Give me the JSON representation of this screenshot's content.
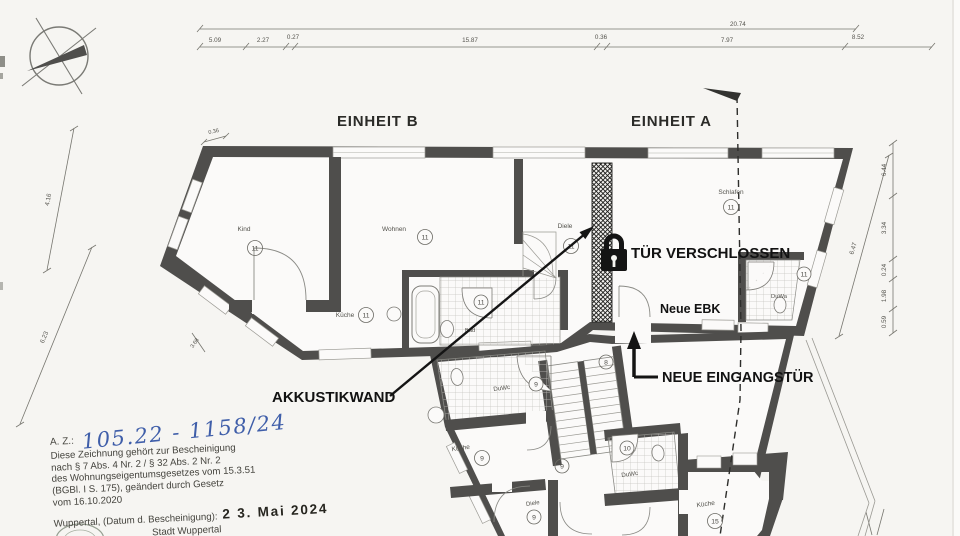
{
  "units": {
    "b": "EINHEIT B",
    "a": "EINHEIT A"
  },
  "annotations": {
    "locked_door": "TÜR VERSCHLOSSEN",
    "new_kitchen": "Neue EBK",
    "new_entrance": "NEUE EINGANGSTÜR",
    "acoustic_wall": "AKKUSTIKWAND"
  },
  "rooms_upper": [
    {
      "label": "Kind",
      "number": "11"
    },
    {
      "label": "Wohnen",
      "number": "11"
    },
    {
      "label": "Küche",
      "number": "11"
    },
    {
      "label": "Bad",
      "number": "11"
    },
    {
      "label": "Diele",
      "number": "11"
    },
    {
      "label": "Schlafen",
      "number": "11"
    },
    {
      "label": "DuWa",
      "number": "11"
    }
  ],
  "rooms_lower": [
    {
      "label": "DuWc",
      "number": "9"
    },
    {
      "label": "Küche",
      "number": "9"
    },
    {
      "label": "Diele",
      "number": "9"
    },
    {
      "label": "DuWc",
      "number": "10"
    },
    {
      "label": "Küche",
      "number": "15"
    },
    {
      "label": "",
      "number": "8"
    },
    {
      "label": "",
      "number": "9"
    }
  ],
  "dimensions": {
    "top_total": "20.74",
    "top_segments": [
      "5.09",
      "2.27",
      "0.27",
      "15.87",
      "0.36",
      "7.97",
      "8.52"
    ],
    "left_upper": "4.16",
    "left_lower": "6.23",
    "corner_small": "0.36",
    "wall_small": "3.68",
    "right_vertical": [
      "6.44",
      "3.34",
      "0.24",
      "1.98",
      "0.59"
    ],
    "right_diagonal": "6.47"
  },
  "legal": {
    "az_label": "A. Z.:",
    "az_number": "105.22 - 1158/24",
    "line1": "Diese Zeichnung gehört zur Bescheinigung",
    "line2": "nach § 7 Abs. 4 Nr. 2 / § 32 Abs. 2 Nr. 2",
    "line3": "des Wohnungseigentumsgesetzes vom 15.3.51",
    "line4": "(BGBl. I S. 175), geändert durch Gesetz",
    "line5": "vom 16.10.2020",
    "city_date_label": "Wuppertal, (Datum d. Bescheinigung):",
    "date_stamp": "2 3.  Mai  2024",
    "issuer1": "Stadt Wuppertal",
    "issuer2": "Der Oberbürgermeister"
  },
  "colors": {
    "wall": "#4f4e4c",
    "paper": "#f6f5f2",
    "ink": "#141414",
    "handwriting_blue": "#3f5ea9"
  }
}
